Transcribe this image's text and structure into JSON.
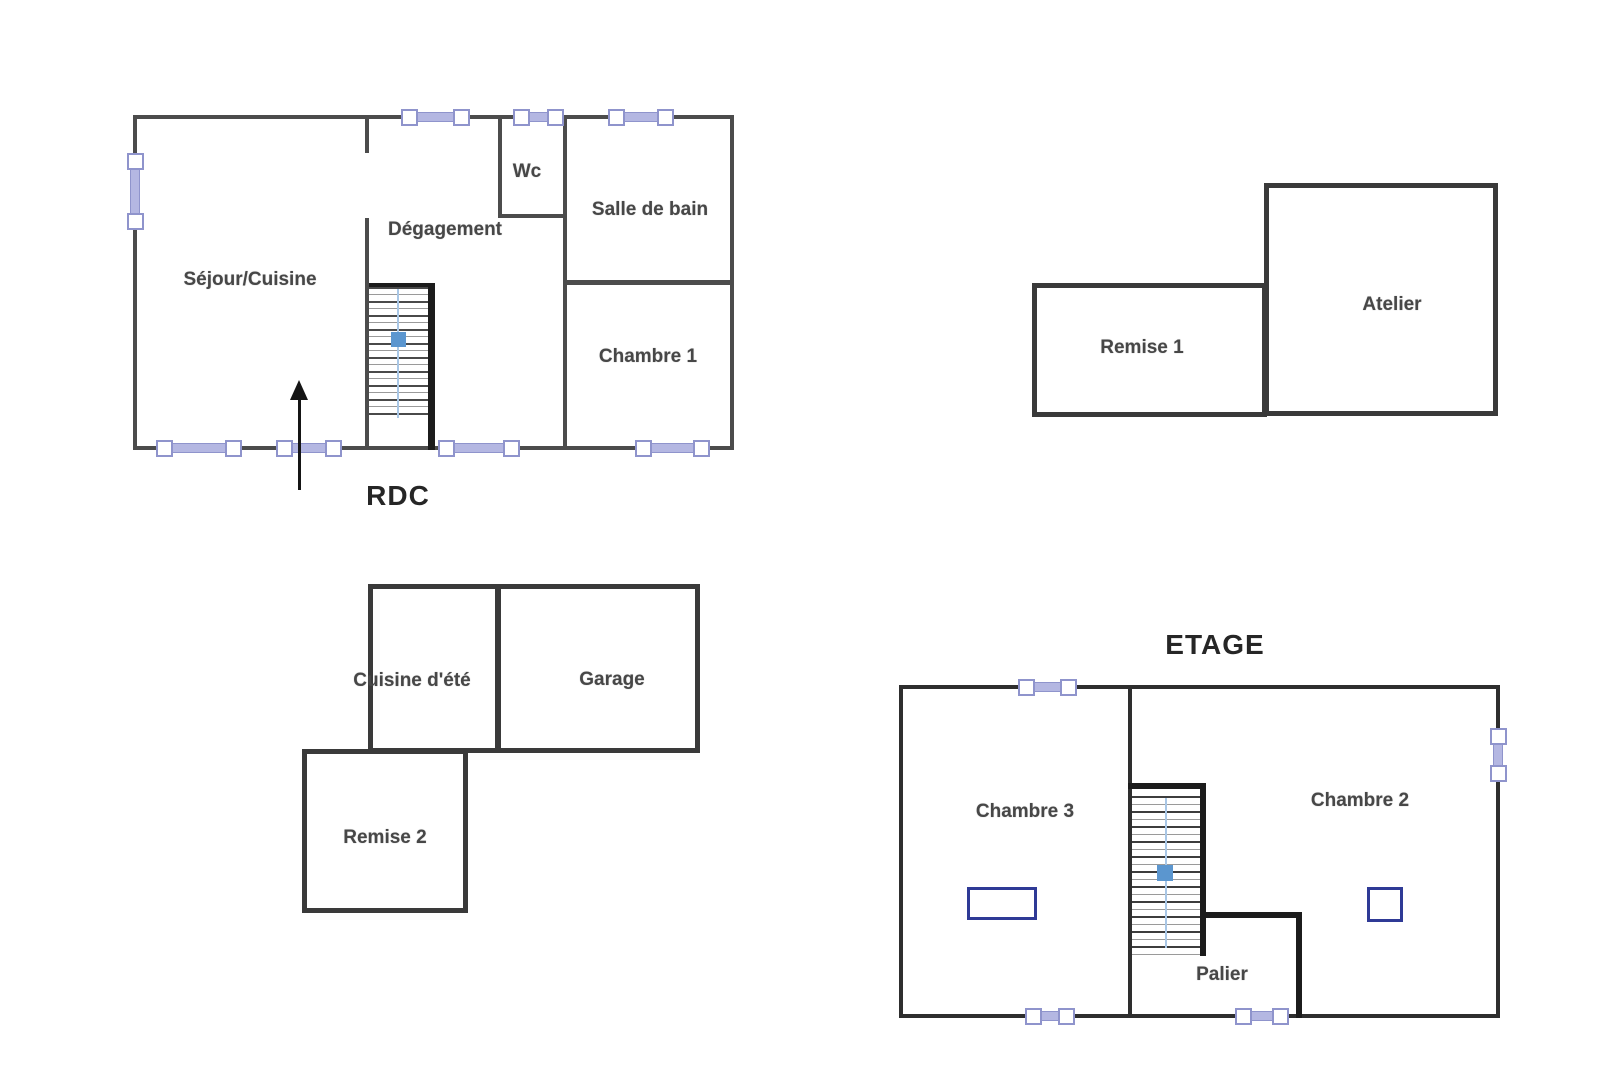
{
  "canvas": {
    "background": "#ffffff"
  },
  "colors": {
    "wall": "#4c4c4c",
    "wall_dark": "#1c1c1c",
    "outbuilding_wall": "#3a3a3a",
    "window_accent": "#8f94cc",
    "window_band": "#b4b7e2",
    "stair_handrail": "#a9c7e6",
    "stair_marker": "#5b96cf",
    "roof_window": "#2f3a96",
    "label_text": "#474747",
    "title_text": "#262626",
    "entrance_arrow": "#151515"
  },
  "rdc": {
    "title": "RDC",
    "rooms": {
      "sejour_cuisine": "Séjour/Cuisine",
      "degagement": "Dégagement",
      "wc": "Wc",
      "salle_de_bain": "Salle de bain",
      "chambre1": "Chambre 1"
    }
  },
  "outbuildings": {
    "remise1": "Remise 1",
    "atelier": "Atelier",
    "cuisine_ete": "Cuisine d'été",
    "garage": "Garage",
    "remise2": "Remise 2"
  },
  "etage": {
    "title": "ETAGE",
    "rooms": {
      "chambre3": "Chambre 3",
      "chambre2": "Chambre 2",
      "palier": "Palier"
    }
  },
  "icons": {
    "window": "window-symbol",
    "roof_window": "roof-window-symbol",
    "entrance_arrow": "up-arrow",
    "stair_direction": "stair-direction-marker"
  }
}
